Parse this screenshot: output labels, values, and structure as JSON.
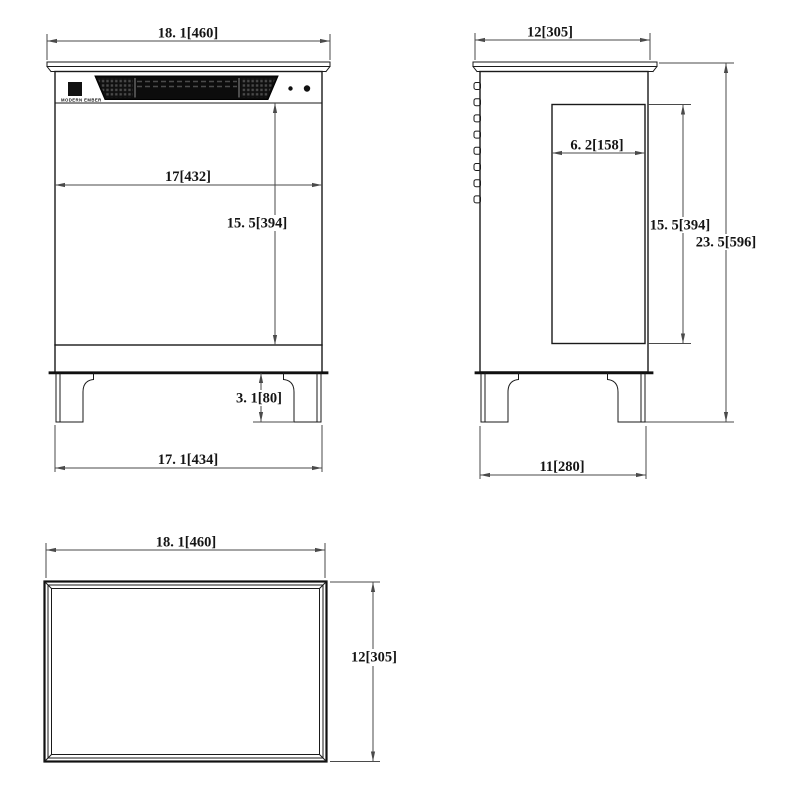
{
  "drawing": {
    "brand": "MODERN EMBER",
    "front": {
      "width_top": "18. 1[460]",
      "width_inner": "17[432]",
      "height_opening": "15. 5[394]",
      "leg_height": "3. 1[80]",
      "width_base": "17. 1[434]"
    },
    "side": {
      "depth_top": "12[305]",
      "depth_recess": "6. 2[158]",
      "height_opening": "15. 5[394]",
      "height_overall": "23. 5[596]",
      "depth_base": "11[280]"
    },
    "top_view": {
      "width": "18. 1[460]",
      "depth": "12[305]"
    },
    "colors": {
      "line": "#1a1a1a",
      "dimension": "#4a4a4a",
      "grille": "#0c0c0c",
      "background": "#ffffff"
    }
  }
}
